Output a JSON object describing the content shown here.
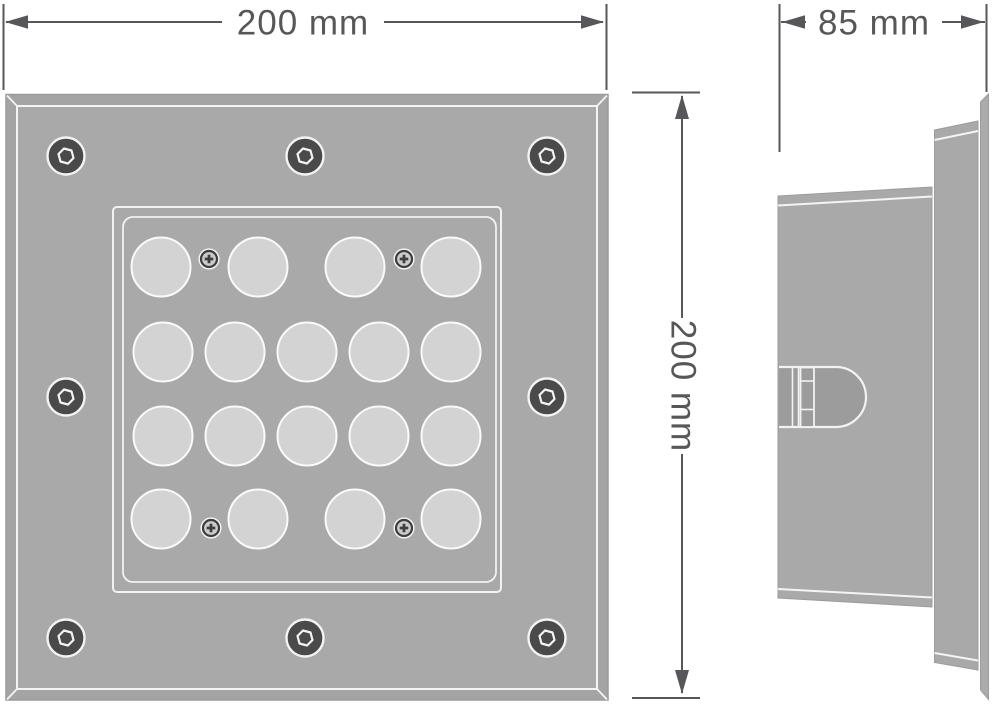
{
  "dimensions": {
    "width": {
      "label": "200 mm"
    },
    "depth": {
      "label": "85 mm"
    },
    "height": {
      "label": "200 mm"
    }
  },
  "front_view": {
    "lens_count": 18,
    "lens_radius": 29.5,
    "lens_rows": [
      {
        "y": 267,
        "x": [
          161,
          258,
          355,
          451
        ]
      },
      {
        "y": 352,
        "x": [
          163,
          235,
          307,
          379,
          451
        ]
      },
      {
        "y": 436,
        "x": [
          163,
          235,
          307,
          379,
          451
        ]
      },
      {
        "y": 519,
        "x": [
          161,
          258,
          355,
          451
        ]
      }
    ],
    "outer_screw_count": 8,
    "outer_screws": [
      [
        66,
        156
      ],
      [
        305,
        156
      ],
      [
        547,
        156
      ],
      [
        66,
        397
      ],
      [
        547,
        397
      ],
      [
        66,
        638
      ],
      [
        305,
        638
      ],
      [
        547,
        638
      ]
    ],
    "small_screw_count": 4,
    "small_screws": [
      [
        209,
        259
      ],
      [
        404,
        259
      ],
      [
        211,
        528
      ],
      [
        404,
        528
      ]
    ]
  },
  "colors": {
    "background": "#ffffff",
    "panel": "#a9a9a9",
    "panel_bevel": "#a4a4a4",
    "lens": "#d3d3d3",
    "outline_white": "#f3f3f3",
    "screw_dark": "#4a4a4a",
    "small_screw_fill": "#cbcbcb",
    "small_screw_dark": "#3e3e3e",
    "side_detail": "#9c9c9c",
    "dimension": "#57575a"
  }
}
